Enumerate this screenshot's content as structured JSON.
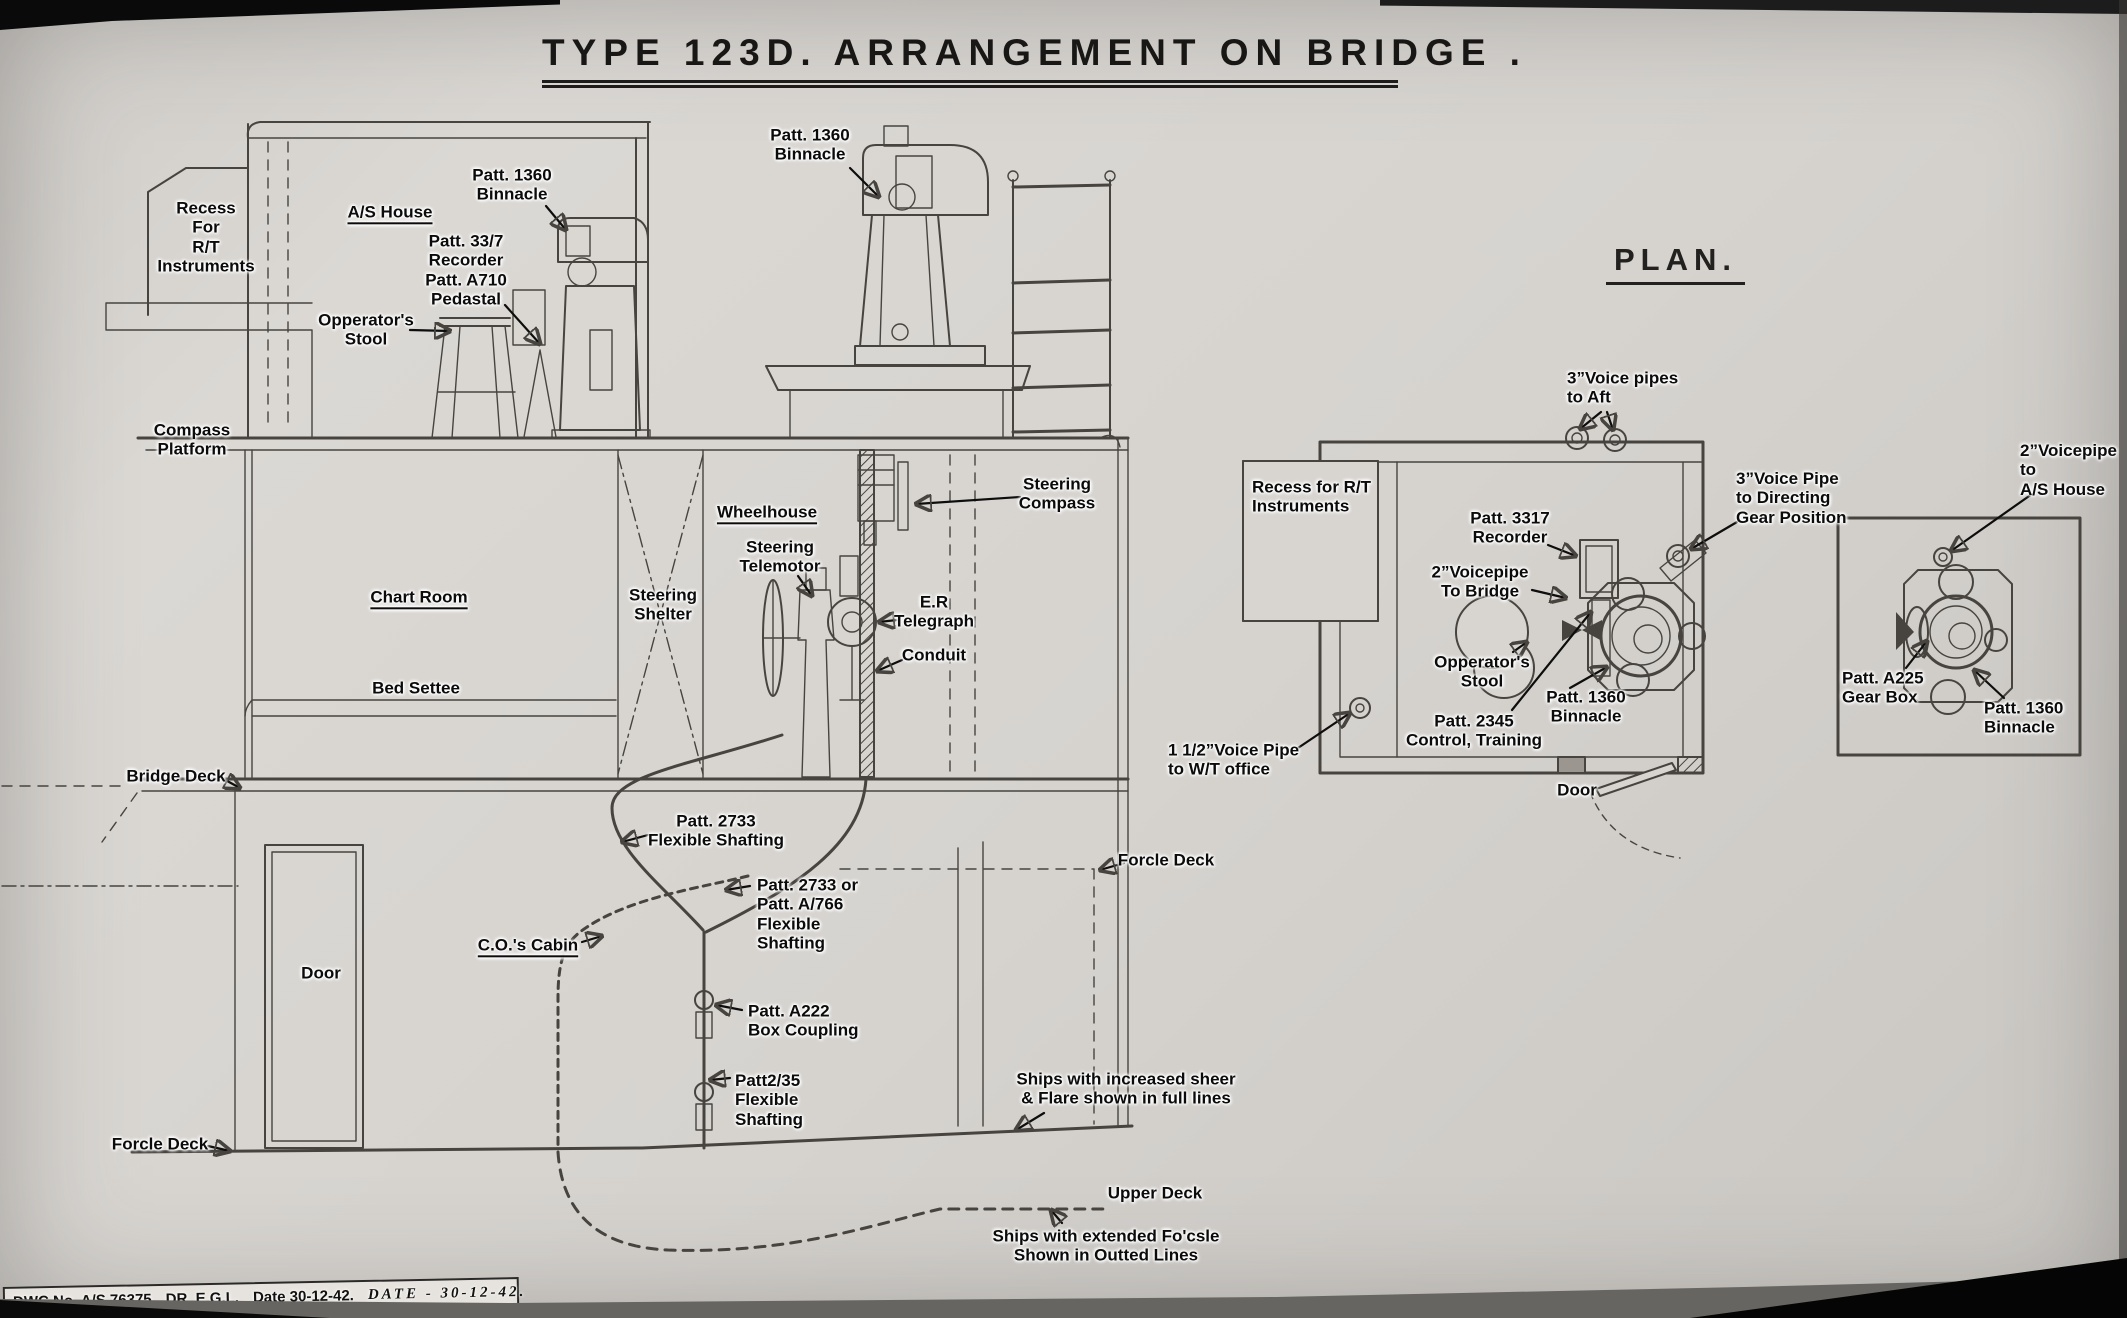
{
  "title": "TYPE 123D.  ARRANGEMENT  ON  BRIDGE .",
  "plan_heading": "PLAN.",
  "labels": {
    "elevation": {
      "recess_rt": "Recess\nFor\nR/T\nInstruments",
      "as_house": "A/S House",
      "patt_1360_binnacle_house": "Patt. 1360\nBinnacle",
      "patt_337_recorder": "Patt. 33/7\nRecorder\nPatt. A710\nPedastal",
      "operators_stool": "Opperator's\nStool",
      "patt_1360_binnacle_top": "Patt. 1360\nBinnacle",
      "compass_platform": "Compass\nPlatform",
      "wheelhouse": "Wheelhouse",
      "steering_telemotor": "Steering\nTelemotor",
      "steering_shelter": "Steering\nShelter",
      "steering_compass": "Steering\nCompass",
      "er_telegraph": "E.R\nTelegraph",
      "conduit": "Conduit",
      "chart_room": "Chart Room",
      "bed_settee": "Bed Settee",
      "bridge_deck": "Bridge Deck",
      "door": "Door",
      "cos_cabin": "C.O.'s Cabin",
      "patt_2733": "Patt. 2733\nFlexible Shafting",
      "patt_2733_or": "Patt. 2733 or\nPatt. A/766\nFlexible\nShafting",
      "patt_a222": "Patt. A222\nBox Coupling",
      "patt_2_35": "Patt2/35\nFlexible\nShafting",
      "forcle_deck_left": "Forcle Deck",
      "forcle_deck_right": "Forcle Deck",
      "ships_full_lines": "Ships with increased sheer\n& Flare shown in full lines",
      "upper_deck": "Upper Deck",
      "ships_dotted_lines": "Ships with extended Fo'csle\nShown in Outted Lines"
    },
    "plan": {
      "voice_pipes_aft": "3”Voice pipes\nto Aft",
      "recess_rt": "Recess for R/T\nInstruments",
      "patt_3317_recorder": "Patt. 3317\nRecorder",
      "voicepipe_2_bridge": "2”Voicepipe\nTo Bridge",
      "voice_pipe_directing": "3”Voice Pipe\nto Directing\nGear Position",
      "operators_stool": "Opperator's\nStool",
      "patt_2345": "Patt. 2345\nControl, Training",
      "patt_1360_binnacle": "Patt. 1360\nBinnacle",
      "voice_pipe_wt": "1 1/2”Voice Pipe\nto W/T office",
      "door": "Door"
    },
    "small_plan": {
      "voicepipe_as_house": "2”Voicepipe to\nA/S House",
      "patt_a225_gearbox": "Patt. A225\nGear Box",
      "patt_1360_binnacle": "Patt. 1360\nBinnacle"
    }
  },
  "title_block": {
    "dwc_no": "DWC No.  A/S 76375",
    "dr": "DR.  E.G.L.",
    "date": "Date 30-12-42.",
    "handwritten_date": "DATE  -  30-12-42."
  },
  "colors": {
    "paper": "#d6d3cf",
    "drawing_ink": "#47443f",
    "label_ink": "#0b0b0b"
  }
}
